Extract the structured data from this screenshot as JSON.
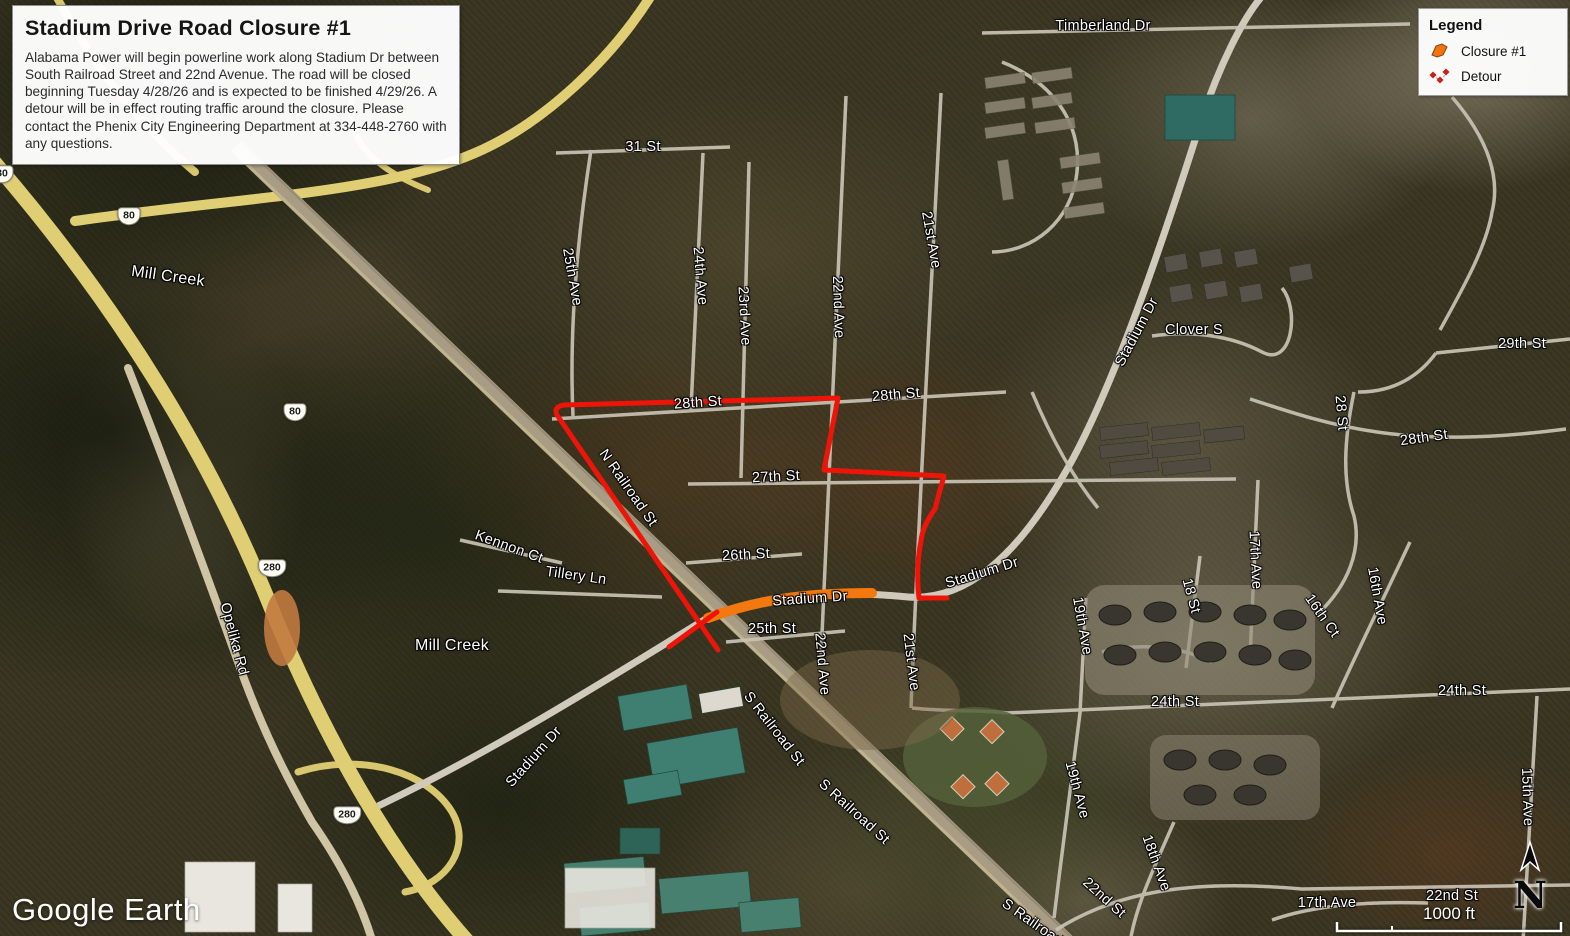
{
  "info_box": {
    "title": "Stadium Drive Road Closure #1",
    "body": "Alabama Power will begin powerline work along Stadium Dr between South Railroad Street and 22nd Avenue. The road will be closed beginning Tuesday 4/28/26 and is expected to be finished 4/29/26. A detour will be in effect routing traffic around the closure. Please contact the Phenix City Engineering Department at 334-448-2760 with any questions."
  },
  "legend": {
    "title": "Legend",
    "items": [
      {
        "label": "Closure #1",
        "icon": "closure-polygon-icon",
        "color": "#F4730C"
      },
      {
        "label": "Detour",
        "icon": "detour-diamonds-icon",
        "color": "#CC1F1A"
      }
    ]
  },
  "branding": {
    "logo_text": "Google Earth"
  },
  "scale_bar": {
    "distance_label": "1000 ft"
  },
  "north_arrow": {
    "label": "N"
  },
  "map": {
    "colors": {
      "closure": "#F2780F",
      "detour": "#EE1508",
      "highway": "#DFCE74",
      "street": "#C9C3B5"
    },
    "shields": [
      {
        "text": "80",
        "x": 129,
        "y": 216
      },
      {
        "text": "80",
        "x": 295,
        "y": 412
      },
      {
        "text": "80",
        "x": 2,
        "y": 174
      },
      {
        "text": "280",
        "x": 272,
        "y": 568
      },
      {
        "text": "280",
        "x": 347,
        "y": 815
      }
    ],
    "labels": [
      {
        "text": "31 St",
        "x": 643,
        "y": 147,
        "rot": 0
      },
      {
        "text": "25th Ave",
        "x": 572,
        "y": 277,
        "rot": 80
      },
      {
        "text": "24th Ave",
        "x": 700,
        "y": 276,
        "rot": 85
      },
      {
        "text": "23rd Ave",
        "x": 744,
        "y": 316,
        "rot": 87
      },
      {
        "text": "22nd Ave",
        "x": 838,
        "y": 307,
        "rot": 88
      },
      {
        "text": "21st Ave",
        "x": 931,
        "y": 240,
        "rot": 80
      },
      {
        "text": "28th St",
        "x": 698,
        "y": 403,
        "rot": -4
      },
      {
        "text": "28th St",
        "x": 896,
        "y": 395,
        "rot": -5
      },
      {
        "text": "27th St",
        "x": 776,
        "y": 477,
        "rot": -3
      },
      {
        "text": "26th St",
        "x": 746,
        "y": 555,
        "rot": -3
      },
      {
        "text": "25th St",
        "x": 772,
        "y": 629,
        "rot": 0
      },
      {
        "text": "N Railroad St",
        "x": 628,
        "y": 488,
        "rot": 55
      },
      {
        "text": "Kennon Ct",
        "x": 509,
        "y": 547,
        "rot": 20
      },
      {
        "text": "Tillery Ln",
        "x": 576,
        "y": 576,
        "rot": 8
      },
      {
        "text": "Stadium Dr",
        "x": 810,
        "y": 599,
        "rot": -4
      },
      {
        "text": "Stadium Dr",
        "x": 982,
        "y": 573,
        "rot": -17
      },
      {
        "text": "Stadium Dr",
        "x": 1137,
        "y": 332,
        "rot": -62
      },
      {
        "text": "Stadium Dr",
        "x": 534,
        "y": 757,
        "rot": -48
      },
      {
        "text": "Mill Creek",
        "x": 168,
        "y": 277,
        "rot": 8,
        "size": 16
      },
      {
        "text": "Mill Creek",
        "x": 452,
        "y": 646,
        "rot": 0,
        "size": 16
      },
      {
        "text": "Opelika Rd",
        "x": 234,
        "y": 639,
        "rot": 75
      },
      {
        "text": "Timberland Dr",
        "x": 1103,
        "y": 26,
        "rot": 0
      },
      {
        "text": "Clover S",
        "x": 1194,
        "y": 330,
        "rot": 0
      },
      {
        "text": "29th St",
        "x": 1522,
        "y": 344,
        "rot": 0
      },
      {
        "text": "28 St",
        "x": 1341,
        "y": 413,
        "rot": 85
      },
      {
        "text": "28th St",
        "x": 1424,
        "y": 438,
        "rot": -8
      },
      {
        "text": "17th Ave",
        "x": 1255,
        "y": 560,
        "rot": 87
      },
      {
        "text": "18 St",
        "x": 1191,
        "y": 596,
        "rot": 75
      },
      {
        "text": "16th Ave",
        "x": 1377,
        "y": 596,
        "rot": 80
      },
      {
        "text": "16th Ct",
        "x": 1322,
        "y": 616,
        "rot": 55
      },
      {
        "text": "19th Ave",
        "x": 1082,
        "y": 626,
        "rot": 80
      },
      {
        "text": "24th St",
        "x": 1175,
        "y": 702,
        "rot": 0
      },
      {
        "text": "24th St",
        "x": 1462,
        "y": 691,
        "rot": 0
      },
      {
        "text": "19th Ave",
        "x": 1077,
        "y": 790,
        "rot": 75
      },
      {
        "text": "18th Ave",
        "x": 1156,
        "y": 863,
        "rot": 70
      },
      {
        "text": "22nd St",
        "x": 1104,
        "y": 898,
        "rot": 42
      },
      {
        "text": "22nd St",
        "x": 1452,
        "y": 896,
        "rot": 0
      },
      {
        "text": "17th Ave",
        "x": 1327,
        "y": 903,
        "rot": 0
      },
      {
        "text": "15th Ave",
        "x": 1527,
        "y": 797,
        "rot": 88
      },
      {
        "text": "22nd Ave",
        "x": 822,
        "y": 664,
        "rot": 85
      },
      {
        "text": "21st Ave",
        "x": 911,
        "y": 662,
        "rot": 83
      },
      {
        "text": "S Railroad St",
        "x": 774,
        "y": 729,
        "rot": 52
      },
      {
        "text": "S Railroad St",
        "x": 854,
        "y": 812,
        "rot": 42
      },
      {
        "text": "S Railroad St",
        "x": 1040,
        "y": 928,
        "rot": 35
      }
    ]
  }
}
